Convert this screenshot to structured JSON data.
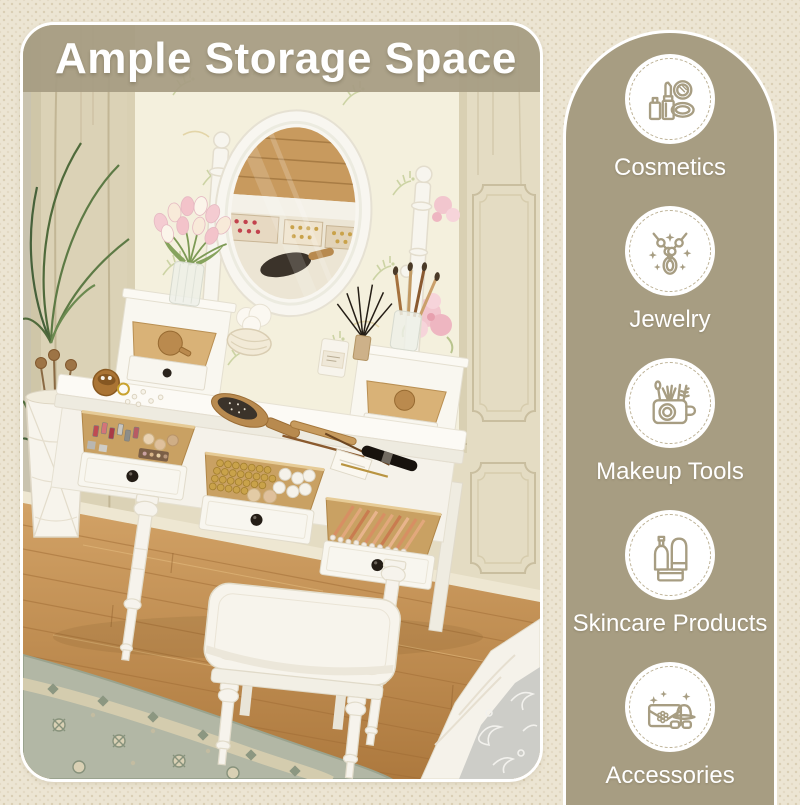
{
  "banner": {
    "title": "Ample Storage Space"
  },
  "features_panel": {
    "items": [
      {
        "id": "cosmetics",
        "label": "Cosmetics"
      },
      {
        "id": "jewelry",
        "label": "Jewelry"
      },
      {
        "id": "makeup-tools",
        "label": "Makeup Tools"
      },
      {
        "id": "skincare-products",
        "label": "Skincare Products"
      },
      {
        "id": "accessories",
        "label": "Accessories"
      }
    ]
  },
  "photo": {
    "subject": "White vanity dressing table with oval swivel mirror, two tabletop mini drawers, three open storage drawers filled with cosmetics, and a cushioned stool in a vintage bedroom"
  },
  "colors": {
    "page_background": "#ece5d3",
    "panel_and_banner": "#a79d82",
    "text": "#ffffff",
    "icon_line": "#a79d82",
    "wood_floor": "#c3924f",
    "drawer_wood": "#c9a163"
  }
}
